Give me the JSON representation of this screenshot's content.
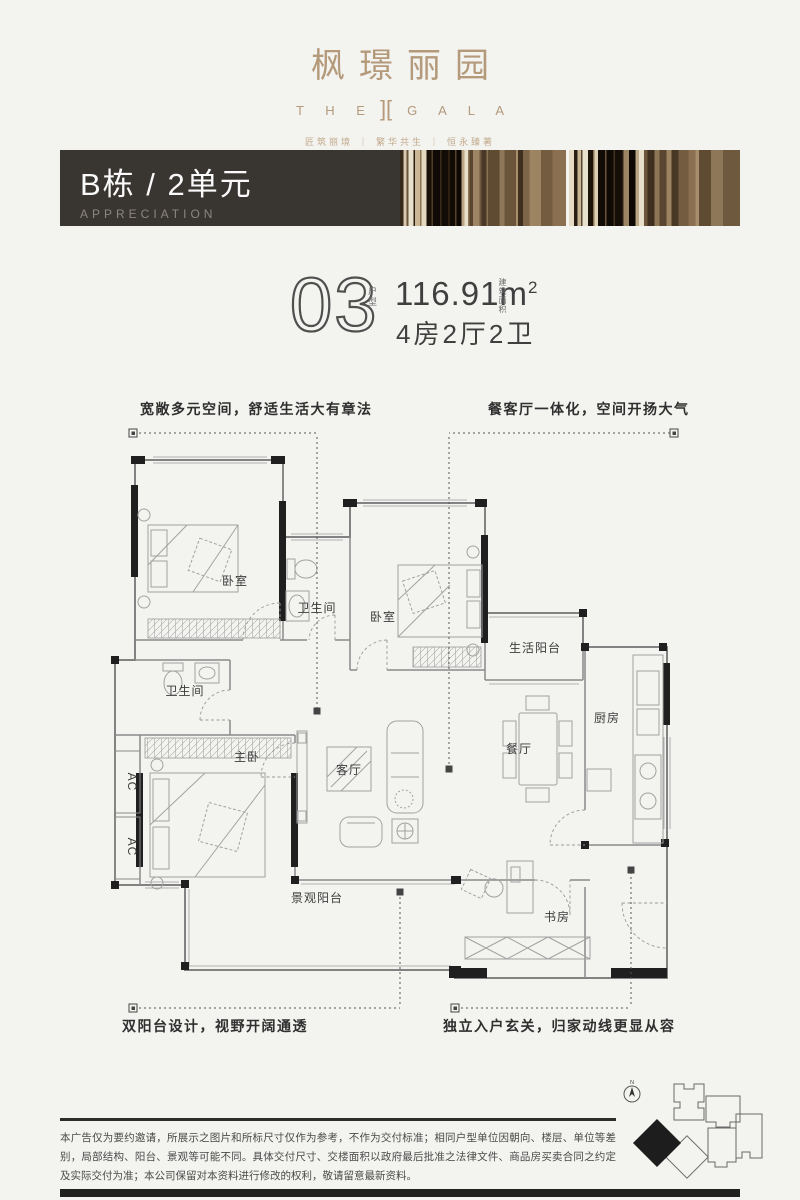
{
  "logo": {
    "title_cn": "枫璟丽园",
    "en_left": "T H E",
    "en_mark": "][",
    "en_right": "G A L A",
    "tagline": "匠筑丽境 ｜ 繁华共生 ｜ 恒永臻著"
  },
  "banner": {
    "title": "B栋 / 2单元",
    "subtitle": "APPRECIATION"
  },
  "unit": {
    "number": "03",
    "number_side": "户型",
    "area": "116.91m",
    "area_sup": "2",
    "area_note": "建筑面积",
    "layout": "4房2厅2卫"
  },
  "annotations": {
    "top_left": "宽敞多元空间，舒适生活大有章法",
    "top_right": "餐客厅一体化，空间开扬大气",
    "bottom_left": "双阳台设计，视野开阔通透",
    "bottom_right": "独立入户玄关，归家动线更显从容"
  },
  "plan": {
    "labels": [
      {
        "id": "bedroom-1",
        "text": "卧室"
      },
      {
        "id": "bath-1",
        "text": "卫生间"
      },
      {
        "id": "bedroom-2",
        "text": "卧室"
      },
      {
        "id": "service-balcony",
        "text": "生活阳台"
      },
      {
        "id": "kitchen",
        "text": "厨房"
      },
      {
        "id": "dining",
        "text": "餐厅"
      },
      {
        "id": "bath-2",
        "text": "卫生间"
      },
      {
        "id": "master-bedroom",
        "text": "主卧"
      },
      {
        "id": "living",
        "text": "客厅"
      },
      {
        "id": "view-balcony",
        "text": "景观阳台"
      },
      {
        "id": "study",
        "text": "书房"
      },
      {
        "id": "ac-1",
        "text": "AC"
      },
      {
        "id": "ac-2",
        "text": "AC"
      }
    ]
  },
  "keyplan": {
    "north": "N"
  },
  "disclaimer": {
    "text": "本广告仅为要约邀请，所展示之图片和所标尺寸仅作为参考，不作为交付标准；相同户型单位因朝向、楼层、单位等差别，局部结构、阳台、景观等可能不同。具体交付尺寸、交楼面积以政府最后批准之法律文件、商品房买卖合同之约定及实际交付为准；本公司保留对本资料进行修改的权利，敬请留意最新资料。"
  },
  "colors": {
    "accent": "#b49a7b",
    "banner_bg": "#393632",
    "ink": "#23211e"
  }
}
